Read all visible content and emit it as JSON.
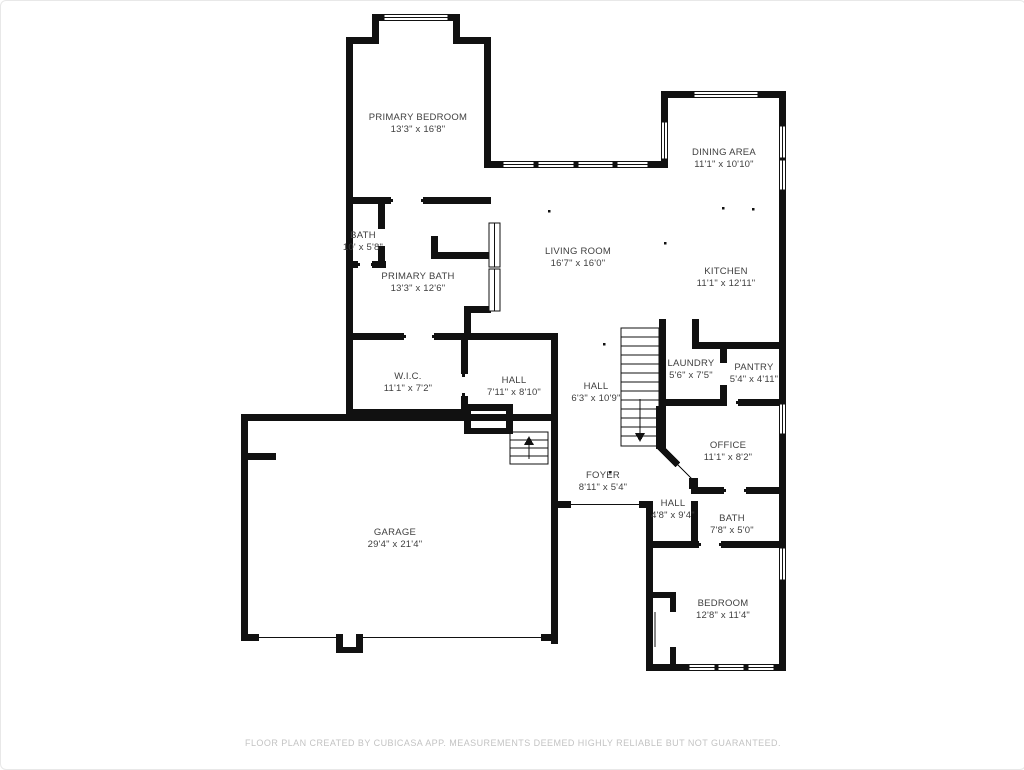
{
  "plan": {
    "footer": "FLOOR PLAN CREATED BY CUBICASA APP. MEASUREMENTS DEEMED HIGHLY RELIABLE BUT NOT GUARANTEED.",
    "colors": {
      "wall": "#111111",
      "label_text": "#3f3f3f",
      "footer_text": "#c3c3c3",
      "background": "#ffffff"
    },
    "rooms": {
      "primary_bedroom": {
        "name": "PRIMARY BEDROOM",
        "dims": "13'3\" x 16'8\""
      },
      "bath_upper": {
        "name": "BATH",
        "dims": "10' x 5'8\""
      },
      "primary_bath": {
        "name": "PRIMARY BATH",
        "dims": "13'3\" x 12'6\""
      },
      "wic": {
        "name": "W.I.C.",
        "dims": "11'1\" x 7'2\""
      },
      "hall_upper": {
        "name": "HALL",
        "dims": "7'11\" x 8'10\""
      },
      "hall_stairs": {
        "name": "HALL",
        "dims": "6'3\" x 10'9\""
      },
      "living_room": {
        "name": "LIVING ROOM",
        "dims": "16'7\" x 16'0\""
      },
      "dining_area": {
        "name": "DINING AREA",
        "dims": "11'1\" x 10'10\""
      },
      "kitchen": {
        "name": "KITCHEN",
        "dims": "11'1\" x 12'11\""
      },
      "laundry": {
        "name": "LAUNDRY",
        "dims": "5'6\" x 7'5\""
      },
      "pantry": {
        "name": "PANTRY",
        "dims": "5'4\" x 4'11\""
      },
      "office": {
        "name": "OFFICE",
        "dims": "11'1\" x 8'2\""
      },
      "foyer": {
        "name": "FOYER",
        "dims": "8'11\" x 5'4\""
      },
      "hall_lower": {
        "name": "HALL",
        "dims": "4'8\" x 9'4\""
      },
      "bath_lower": {
        "name": "BATH",
        "dims": "7'8\" x 5'0\""
      },
      "bedroom": {
        "name": "BEDROOM",
        "dims": "12'8\" x 11'4\""
      },
      "garage": {
        "name": "GARAGE",
        "dims": "29'4\" x 21'4\""
      }
    }
  }
}
